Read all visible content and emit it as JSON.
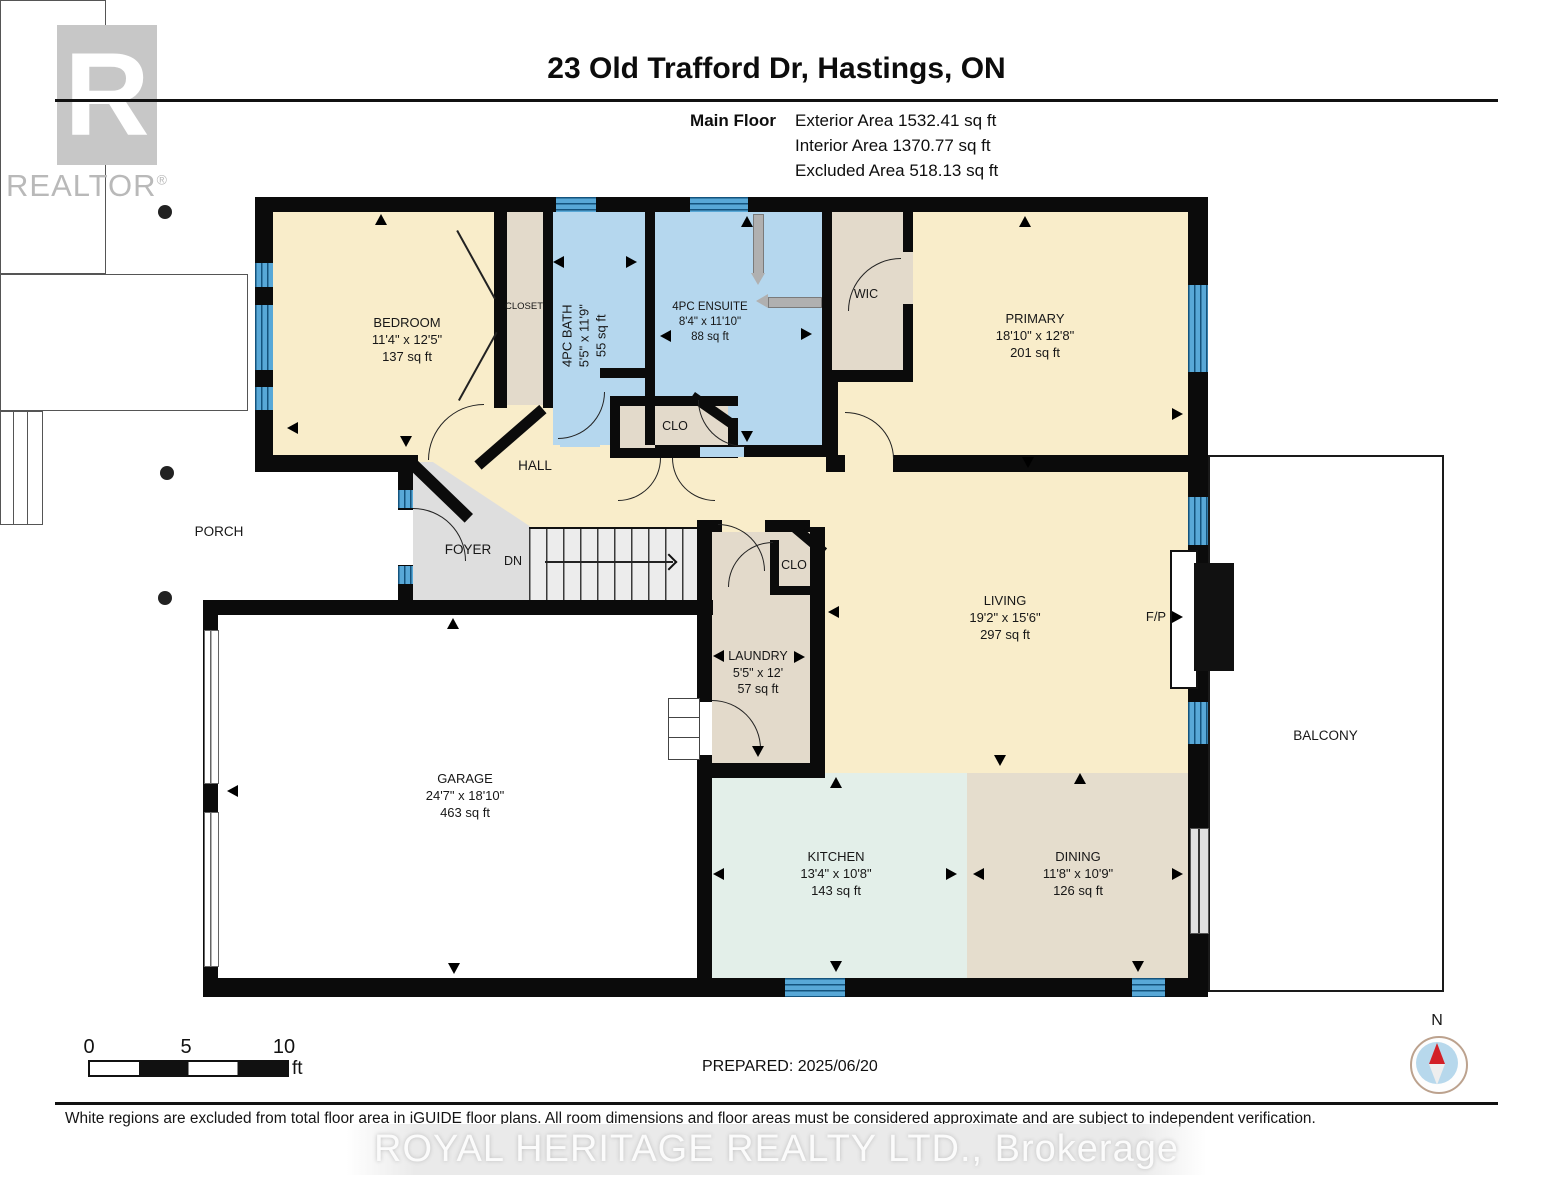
{
  "header": {
    "title": "23 Old Trafford Dr, Hastings, ON",
    "logo": {
      "letter": "R",
      "text": "REALTOR",
      "mark": "®"
    },
    "floor_label": "Main Floor",
    "stats": [
      "Exterior Area 1532.41 sq ft",
      "Interior Area 1370.77 sq ft",
      "Excluded Area 518.13 sq ft"
    ]
  },
  "rooms": [
    {
      "name": "BEDROOM",
      "dim": "11'4\" x 12'5\"",
      "area": "137 sq ft"
    },
    {
      "name": "PRIMARY",
      "dim": "18'10\" x 12'8\"",
      "area": "201 sq ft"
    },
    {
      "name": "4PC BATH",
      "dim": "5'5\" x 11'9\"",
      "area": "55 sq ft"
    },
    {
      "name": "4PC ENSUITE",
      "dim": "8'4\" x 11'10\"",
      "area": "88 sq ft"
    },
    {
      "name": "LIVING",
      "dim": "19'2\" x 15'6\"",
      "area": "297 sq ft"
    },
    {
      "name": "LAUNDRY",
      "dim": "5'5\" x 12'",
      "area": "57 sq ft"
    },
    {
      "name": "GARAGE",
      "dim": "24'7\" x 18'10\"",
      "area": "463 sq ft"
    },
    {
      "name": "KITCHEN",
      "dim": "13'4\" x 10'8\"",
      "area": "143 sq ft"
    },
    {
      "name": "DINING",
      "dim": "11'8\" x 10'9\"",
      "area": "126 sq ft"
    }
  ],
  "labels": {
    "closet": "CLOSET",
    "wic": "WIC",
    "clo_hall": "CLO",
    "clo_laundry": "CLO",
    "hall": "HALL",
    "porch": "PORCH",
    "foyer": "FOYER",
    "dn": "DN",
    "fireplace": "F/P",
    "balcony": "BALCONY"
  },
  "footer": {
    "scale_ticks": [
      "0",
      "5",
      "10"
    ],
    "scale_unit": "ft",
    "prepared": "PREPARED: 2025/06/20",
    "compass_north": "N",
    "disclaimer": "White regions are excluded from total floor area in iGUIDE floor plans. All room dimensions and floor areas must be considered approximate and are subject to independent verification.",
    "watermark": "ROYAL HERITAGE REALTY LTD.,  Brokerage"
  },
  "colors": {
    "room_cream": "#f9edca",
    "room_blue": "#b5d7ee",
    "room_beige": "#e3dacb",
    "room_mint": "#e3efe9",
    "room_tan": "#e5ddcd",
    "foyer_gray": "#dedede",
    "wall_black": "#0b0b0b",
    "window_blue": "#58a8d7"
  }
}
